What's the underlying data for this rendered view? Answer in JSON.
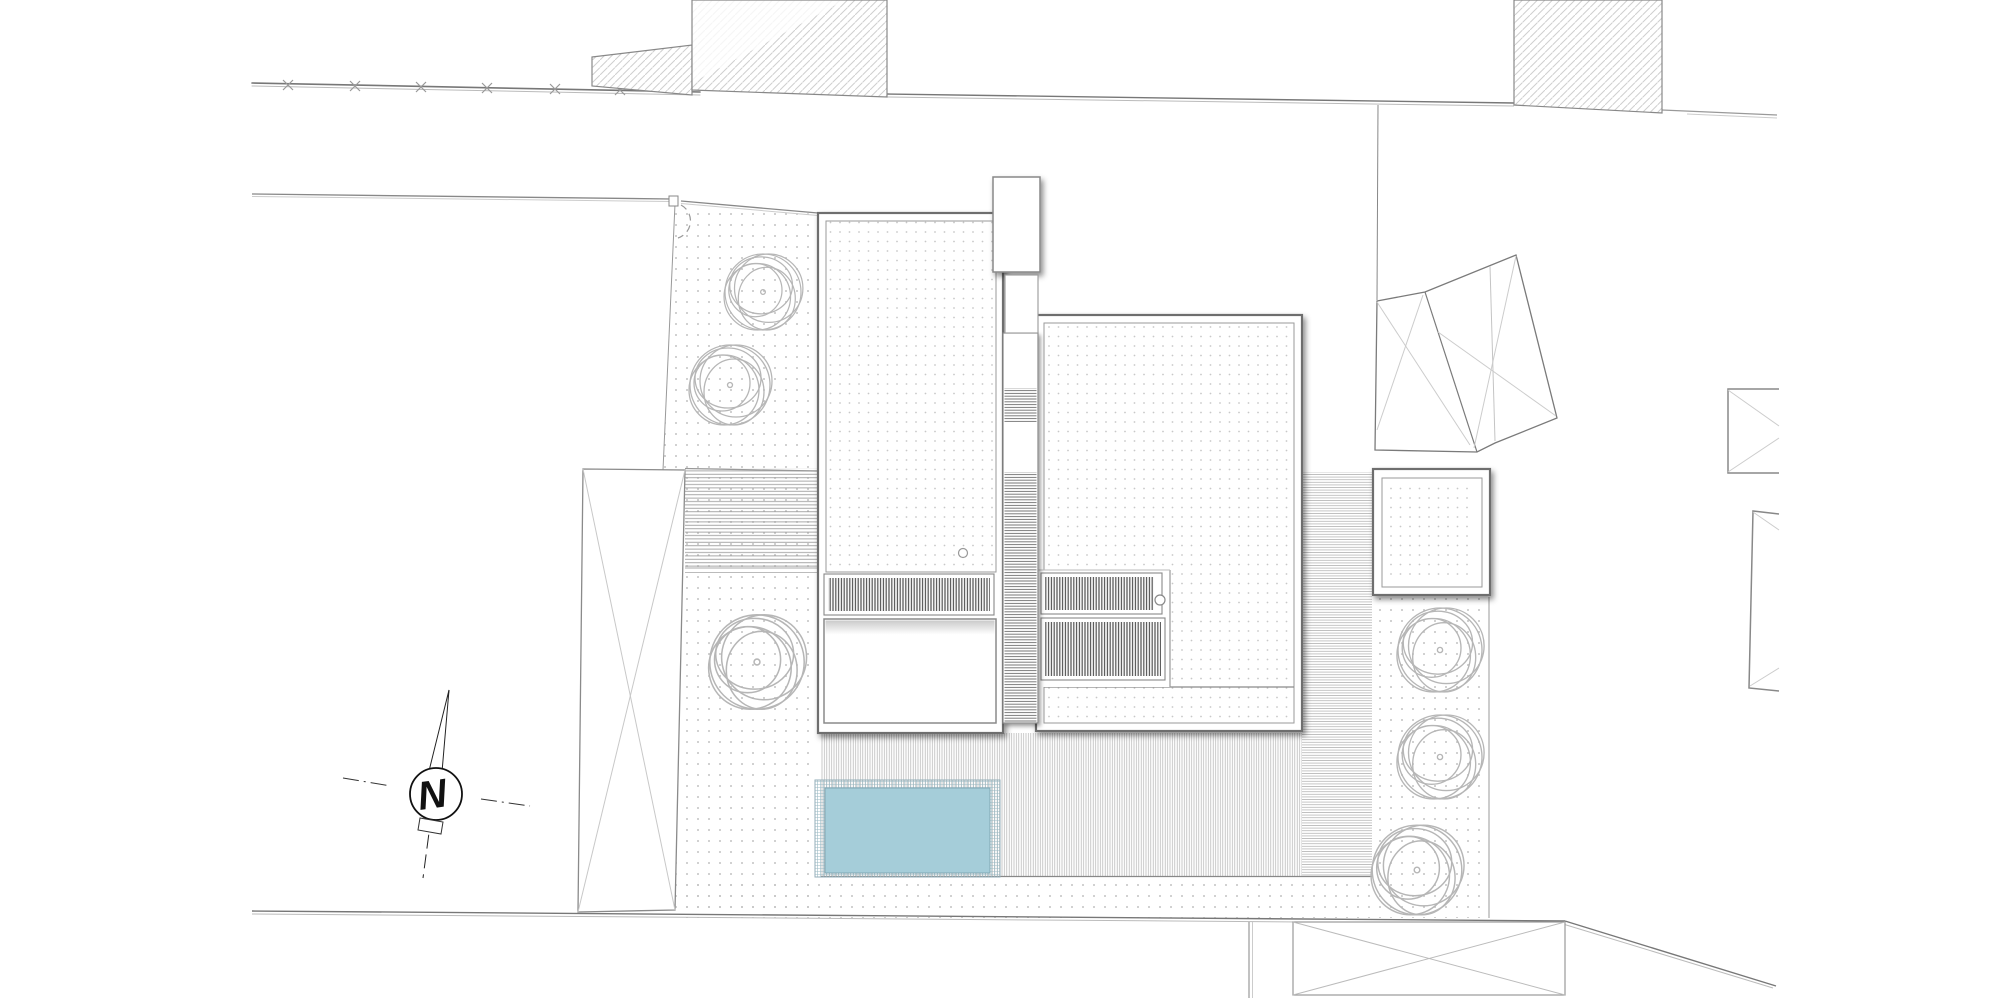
{
  "plan": {
    "type": "architectural-site-plan",
    "visible_text": [
      "N"
    ]
  },
  "compass": {
    "label": "N"
  },
  "colors": {
    "paper": "#ffffff",
    "pool_water": "#a5cdd9",
    "pool_edge_grid": "#9bbac4",
    "ground_dots": "#c2c2c2",
    "roof_dots": "#c8c8c8",
    "neighbor_hatch": "#cfcfcf",
    "boundary_line": "#777777",
    "detail_line": "#888888",
    "louver_stripe": "#4f4f4f",
    "deck_stripe": "#b2b2b2",
    "tree_stroke": "#b6b6b6"
  }
}
